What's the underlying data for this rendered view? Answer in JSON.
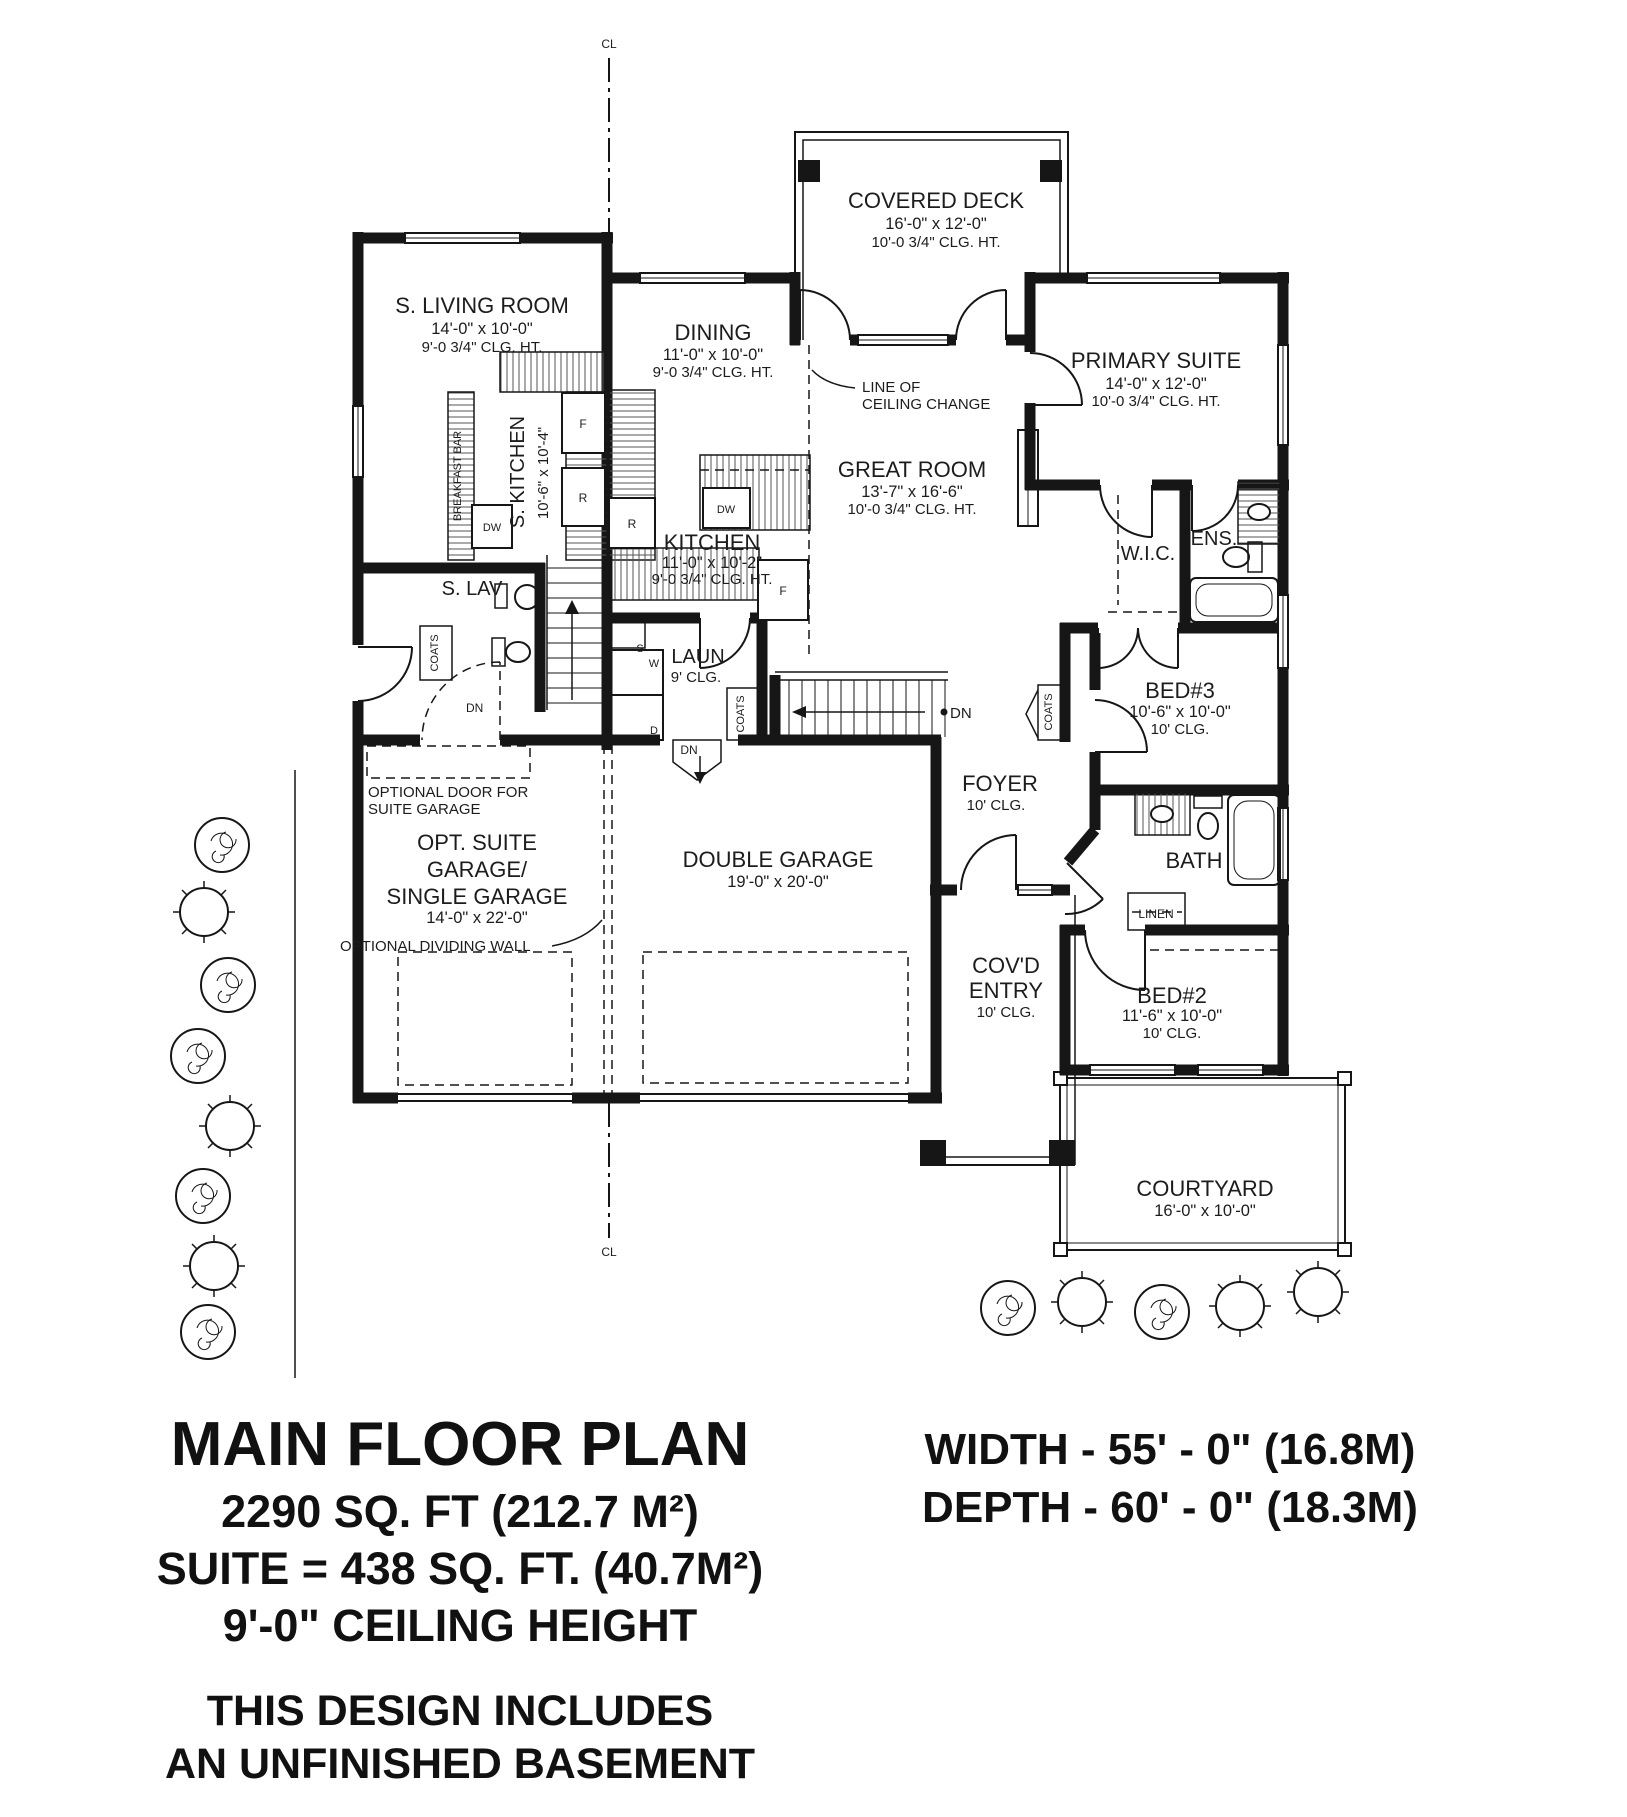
{
  "page": {
    "bg": "#ffffff",
    "ink": "#1c1c1c"
  },
  "rooms": {
    "covered_deck": {
      "name": "COVERED DECK",
      "dim": "16'-0\" x 12'-0\"",
      "clg": "10'-0 3/4\" CLG. HT."
    },
    "s_living": {
      "name": "S. LIVING ROOM",
      "dim": "14'-0\" x 10'-0\"",
      "clg": "9'-0 3/4\" CLG. HT."
    },
    "dining": {
      "name": "DINING",
      "dim": "11'-0\" x 10'-0\"",
      "clg": "9'-0 3/4\" CLG. HT."
    },
    "primary": {
      "name": "PRIMARY SUITE",
      "dim": "14'-0\" x 12'-0\"",
      "clg": "10'-0 3/4\" CLG. HT."
    },
    "great": {
      "name": "GREAT ROOM",
      "dim": "13'-7\" x 16'-6\"",
      "clg": "10'-0 3/4\" CLG. HT."
    },
    "kitchen": {
      "name": "KITCHEN",
      "dim": "11'-0\" x 10'-2\"",
      "clg": "9'-0 3/4\" CLG. HT."
    },
    "s_kitchen": {
      "name": "S. KITCHEN",
      "dim": "10'-6\" x 10'-4\""
    },
    "s_lav": {
      "name": "S. LAV"
    },
    "laun": {
      "name": "LAUN",
      "clg": "9' CLG."
    },
    "wic": {
      "name": "W.I.C."
    },
    "ens": {
      "name": "ENS."
    },
    "bed3": {
      "name": "BED#3",
      "dim": "10'-6\" x 10'-0\"",
      "clg": "10' CLG."
    },
    "foyer": {
      "name": "FOYER",
      "clg": "10' CLG."
    },
    "opt_garage": {
      "line1": "OPT. SUITE",
      "line2": "GARAGE/",
      "line3": "SINGLE GARAGE",
      "dim": "14'-0\" x 22'-0\""
    },
    "dbl_garage": {
      "name": "DOUBLE GARAGE",
      "dim": "19'-0\" x 20'-0\""
    },
    "covd_entry": {
      "line1": "COV'D",
      "line2": "ENTRY",
      "clg": "10' CLG."
    },
    "bath": {
      "name": "BATH"
    },
    "linen": {
      "name": "LINEN"
    },
    "bed2": {
      "name": "BED#2",
      "dim": "11'-6\" x 10'-0\"",
      "clg": "10' CLG."
    },
    "courtyard": {
      "name": "COURTYARD",
      "dim": "16'-0\" x 10'-0\""
    }
  },
  "annotations": {
    "ceiling_change_line1": "LINE OF",
    "ceiling_change_line2": "CEILING CHANGE",
    "optional_door_line1": "OPTIONAL DOOR FOR",
    "optional_door_line2": "SUITE GAR AGE",
    "optional_door_line2_fixed": "SUITE GARAGE",
    "dividing_wall": "OPTIONAL DIVIDING WALL",
    "breakfast_bar": "BREAKFAST BAR",
    "coats": "COATS",
    "dn": "DN",
    "centerline": "CL"
  },
  "appliances": {
    "dishwasher": "DW",
    "fridge": "F",
    "range": "R",
    "sink": "S",
    "washer": "W",
    "dryer": "D"
  },
  "title_block": {
    "title": "MAIN FLOOR PLAN",
    "area": "2290 SQ. FT (212.7 M²)",
    "suite_area": "SUITE = 438 SQ. FT. (40.7M²)",
    "ceiling": "9'-0\" CEILING HEIGHT",
    "note_line1": "THIS DESIGN INCLUDES",
    "note_line2": "AN UNFINISHED BASEMENT"
  },
  "dimensions_block": {
    "width": "WIDTH - 55' - 0\" (16.8M)",
    "depth": "DEPTH - 60' - 0\" (18.3M)"
  }
}
